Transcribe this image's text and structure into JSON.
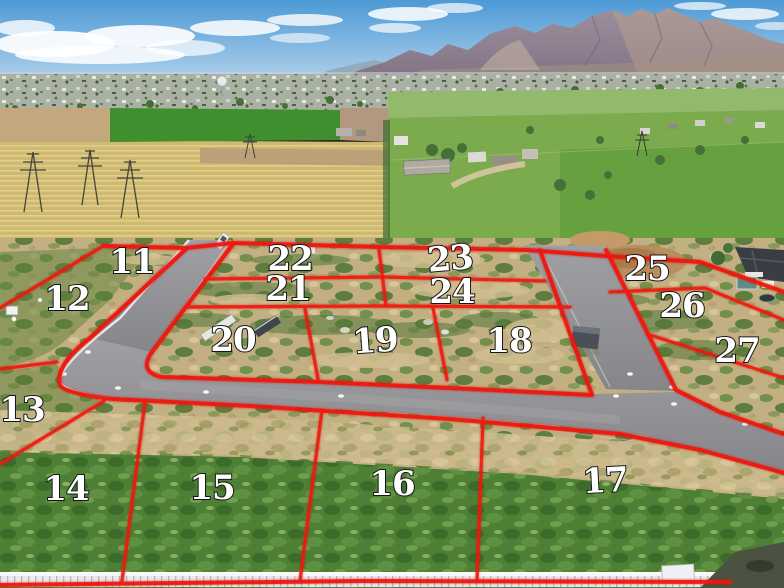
{
  "overlay": {
    "line_color": "#ee1a0c",
    "label_color": "#ffffff",
    "label_outline_color": "#161616"
  },
  "lots": [
    {
      "label": "11"
    },
    {
      "label": "12"
    },
    {
      "label": "13"
    },
    {
      "label": "14"
    },
    {
      "label": "15"
    },
    {
      "label": "16"
    },
    {
      "label": "17"
    },
    {
      "label": "18"
    },
    {
      "label": "19"
    },
    {
      "label": "20"
    },
    {
      "label": "21"
    },
    {
      "label": "22"
    },
    {
      "label": "23"
    },
    {
      "label": "24"
    },
    {
      "label": "25"
    },
    {
      "label": "26"
    },
    {
      "label": "27"
    }
  ]
}
